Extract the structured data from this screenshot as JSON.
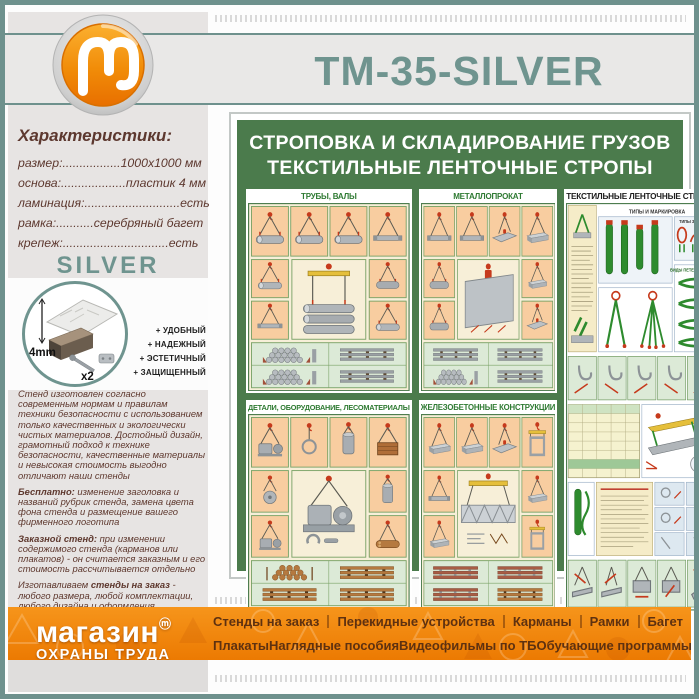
{
  "header": {
    "product_title": "ТМ-35-SILVER"
  },
  "characteristics": {
    "heading": "Характеристики:",
    "rows": [
      "размер:.................1000x1000 мм",
      "основа:...................пластик 4 мм",
      "ламинация:............................есть",
      "рамка:...........серебряный багет",
      "крепеж:...............................есть"
    ]
  },
  "frame_info": {
    "series_label": "SILVER",
    "thickness_label": "4mm",
    "screws_label": "x2",
    "features": [
      "+ УДОБНЫЙ",
      "+ НАДЕЖНЫЙ",
      "+ ЭСТЕТИЧНЫЙ",
      "+ ЗАЩИЩЕННЫЙ"
    ]
  },
  "description": {
    "p1": "Стенд изготовлен согласно современным нормам и правилам техники безопасности с использованием только качественных и экологически чистых материалов. Достойный дизайн, грамотный подход к технике безопасности, качественные материалы и невысокая стоимость выгодно отличают наши стенды",
    "p2_bold": "Бесплатно:",
    "p2_text": " изменение заголовка и названий рубрик стенда, замена цвета фона стенда и размещение вашего фирменного логотипа",
    "p3_bold": "Заказной стенд:",
    "p3_text": " при изменении содержимого стенда (карманов или плакатов) - он считается заказным и его стоимость рассчитывается отдельно",
    "p4_pre": "Изготавливаем ",
    "p4_bold": "стенды на заказ",
    "p4_text": " - любого размера, любой комплектации, любого дизайна и оформления"
  },
  "poster": {
    "title_line1": "СТРОПОВКА И СКЛАДИРОВАНИЕ ГРУЗОВ",
    "title_line2": "ТЕКСТИЛЬНЫЕ ЛЕНТОЧНЫЕ СТРОПЫ",
    "panels": {
      "pipes": "ТРУБЫ, ВАЛЫ",
      "metal": "МЕТАЛЛОПРОКАТ",
      "textile": "ТЕКСТИЛЬНЫЕ ЛЕНТОЧНЫЕ СТРОПЫ",
      "details": "ДЕТАЛИ, ОБОРУДОВАНИЕ, ЛЕСОМАТЕРИАЛЫ",
      "concrete": "ЖЕЛЕЗОБЕТОННЫЕ КОНСТРУКЦИИ"
    },
    "textile_subheads": {
      "types": "ТИПЫ И МАРКИРОВКА",
      "links": "ТИПЫ ЗВЕНЬЕВ",
      "loops": "ВИДЫ ПЕТЕЛЬ СТРОПОВ"
    }
  },
  "footer": {
    "brand_line1": "магазин",
    "brand_mark": "ⓜ",
    "brand_line2": "ОХРАНЫ ТРУДА",
    "menu_row1": [
      "Стенды на заказ",
      "Перекидные устройства",
      "Карманы",
      "Рамки",
      "Багет"
    ],
    "menu_row2": [
      "Плакаты",
      "Наглядные пособия",
      "Видеофильмы по ТБ",
      "Обучающие программы"
    ]
  },
  "colors": {
    "accent_sage": "#6f948f",
    "poster_green": "#4b7b4c",
    "footer_orange": "#ef7d05",
    "text_maroon": "#5e382e"
  }
}
